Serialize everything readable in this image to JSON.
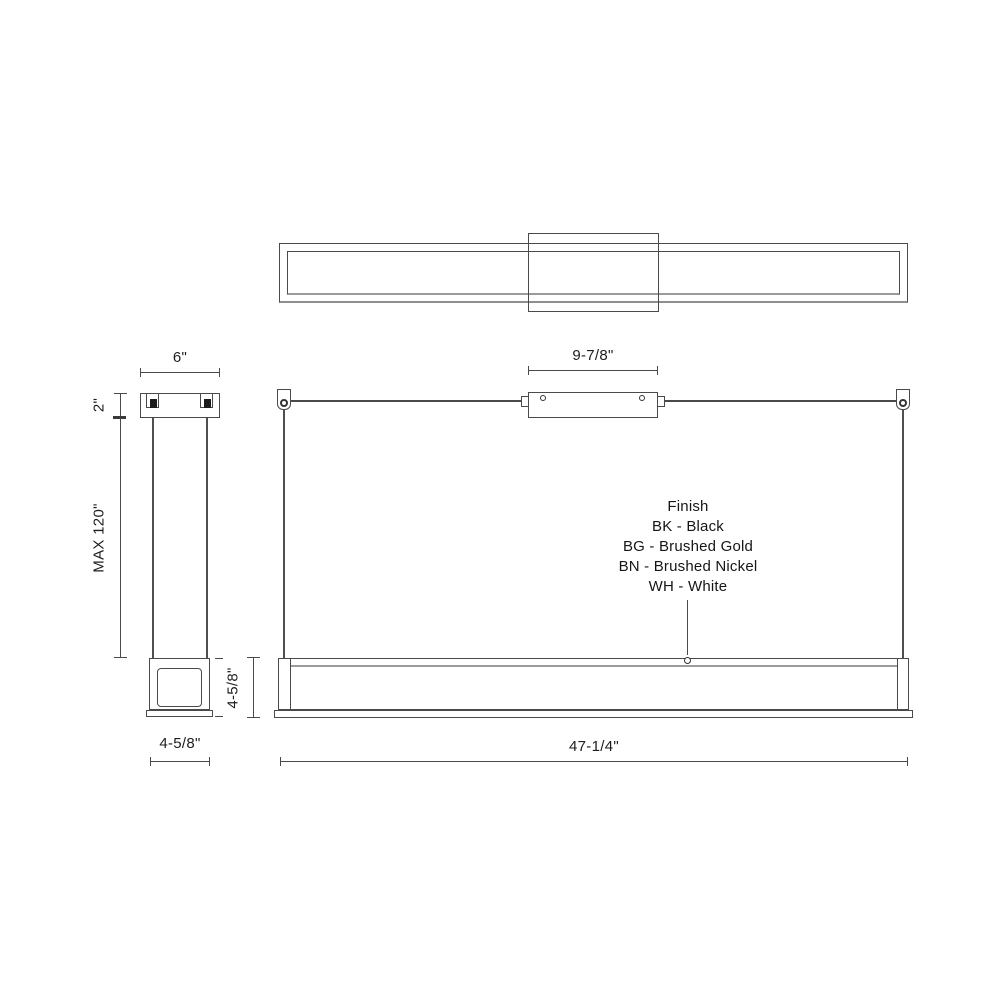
{
  "drawing": {
    "type": "linear-pendant-light-dimension-drawing",
    "views": {
      "top_view": "plan view of linear fixture with center canopy",
      "side_view": "end elevation with canopy, suspension cables, fixture section",
      "front_view": "front elevation with ceiling line, two cable anchors, center canopy, linear fixture"
    },
    "dims": {
      "side_canopy_width": "6\"",
      "side_canopy_height": "2\"",
      "max_suspension": "MAX 120\"",
      "side_body_width": "4-5/8\"",
      "front_body_height": "4-5/8\"",
      "front_canopy_width": "9-7/8\"",
      "front_length": "47-1/4\""
    },
    "finish": {
      "title": "Finish",
      "options": [
        "BK - Black",
        "BG - Brushed Gold",
        "BN - Brushed Nickel",
        "WH - White"
      ]
    },
    "colors": {
      "line": "#4a4a4a",
      "shadow_line": "#9b9b9b",
      "text": "#1d1d1d",
      "background": "#ffffff"
    }
  }
}
